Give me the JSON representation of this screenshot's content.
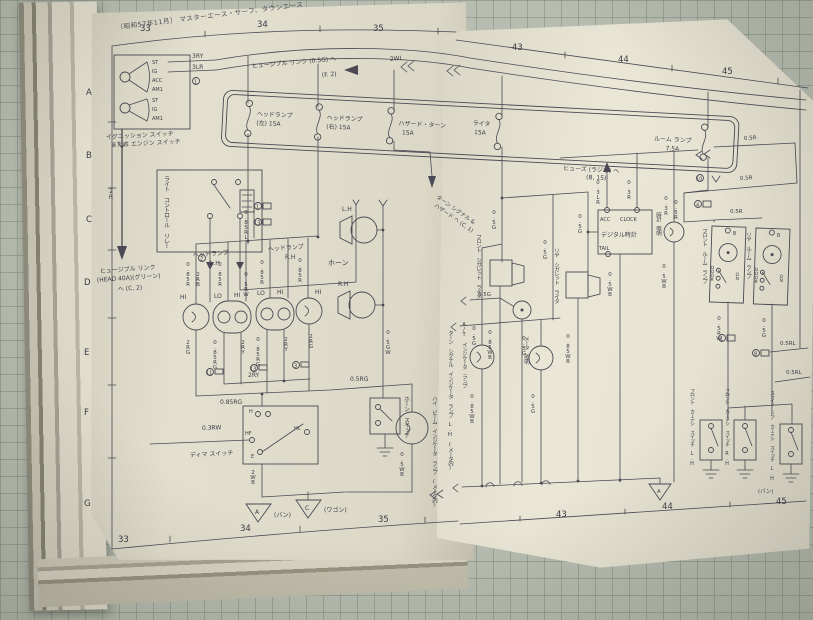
{
  "header": {
    "edition": "〔昭和57年11月〕",
    "models": "マスターエース・サーフ、タウンエース"
  },
  "grid_ruler": {
    "top_left": [
      "33",
      "34",
      "35"
    ],
    "top_right": [
      "43",
      "44",
      "45"
    ],
    "bottom_left": [
      "33",
      "34",
      "35"
    ],
    "bottom_right": [
      "43",
      "44",
      "45"
    ],
    "rows": [
      "A",
      "B",
      "C",
      "D",
      "E",
      "F",
      "G"
    ]
  },
  "ignition_switch": {
    "caption1": "イグニッション スイッチ",
    "caption2": "または エンジン スイッチ",
    "upper_terminals": [
      "ST",
      "IG",
      "ACC",
      "AM1"
    ],
    "lower_terminals": [
      "ST",
      "IG",
      "AM1"
    ]
  },
  "fuse_box": {
    "fuses": [
      {
        "name": "ヘッドランプ",
        "rating": "(左) 15A"
      },
      {
        "name": "ヘッドランプ",
        "rating": "(右) 15A"
      },
      {
        "name": "ハザード・ターン",
        "rating": "15A"
      },
      {
        "name": "ライタ",
        "rating": "15A"
      },
      {
        "name": "ルーム ランプ",
        "rating": "7.5A"
      }
    ]
  },
  "notes": {
    "fusible_link_05g": "ヒュージブル リンク (0.5G) ヘ",
    "fusible_link_05g_ref": "(F. 2)",
    "fusible_link_head1": "ヒュージブル リンク",
    "fusible_link_head2": "(HEAD 40A)(グリーン)",
    "fusible_link_head3": "ヘ (C, 2)",
    "fuse_radio1": "ヒューズ (ラジオ) ヘ",
    "fuse_radio2": "(B, 15)",
    "turn_hazard1": "ターン シグナル &",
    "turn_hazard2": "ハザード ヘ (C, 1)"
  },
  "relay": {
    "caption": "ライト コントロール リレー"
  },
  "headlamps": {
    "lh1": "ヘッドランプ",
    "lh2": "L.H",
    "rh1": "ヘッドランプ",
    "rh2": "R.H",
    "hi": "HI",
    "lo": "LO"
  },
  "horn": {
    "caption": "ホーン",
    "lh": "L.H",
    "rh": "R.H",
    "switch": "ホーン スイッチ"
  },
  "dimmer": {
    "caption": "ディマ スイッチ",
    "t_h": "H",
    "t_hl": "HL",
    "t_hf": "HF",
    "t_e": "E"
  },
  "indicators": {
    "high_beam": "ハイ ビーム インジケータ ランプ (メータ内)",
    "turn_lh": "ターン シグナル インジケータ ランプ L.H (メータ内)",
    "at": "A/T インジケータ ランプ",
    "meter": "メータ 照明",
    "clock_illum": "時計 照明"
  },
  "clock": {
    "t_acc": "ACC",
    "t_clock": "CLOCK",
    "name": "デジタル時計",
    "t_tail": "TAIL"
  },
  "lighters": {
    "front": "フロント シガレット ライタ",
    "rear": "リヤ シガレット ライタ"
  },
  "room_lamps": {
    "front": "フロント ルーム ランプ",
    "rear": "リヤ ルーム ランプ",
    "t_b": "B",
    "door": "DOOR",
    "on": "ON"
  },
  "courtesy": {
    "front_lh": "フロント カーテシ スイッチ L.H",
    "front_rh": "フロント カーテシ スイッチ R.H",
    "slide_lh": "スライド ドア カーテシ スイッチ L.H",
    "van": "(バン)"
  },
  "grounds": {
    "a": "A",
    "c": "C",
    "van": "(バン)",
    "wagon": "(ワゴン)",
    "a2": "A"
  },
  "wires": {
    "w2WL": "2WL",
    "w3RY": "3RY",
    "w3LR": "3LR",
    "w2R": "2R",
    "w2RB": "2RB",
    "w05RW": "0.5RW",
    "w085R": "0.85R",
    "w085RL": "0.85RL",
    "w2RG": "2RG",
    "w2RY": "2RY",
    "w085RG": "0.85RG",
    "w05RG": "0.5RG",
    "w03RW": "0.3RW",
    "w2WB": "2WB",
    "w05WB": "0.5WB",
    "w05GW": "0.5GW",
    "w05G": "0.5G",
    "w03R": "0.3R",
    "w03LR": "0.3LR",
    "w05R": "0.5R",
    "w05RL": "0.5RL",
    "w085WB": "0.85WB"
  },
  "connectors": {
    "c1": "1",
    "c2": "2",
    "c3": "3",
    "c4": "4",
    "c8": "8",
    "c10": "10",
    "c11": "11",
    "c13": "13"
  }
}
